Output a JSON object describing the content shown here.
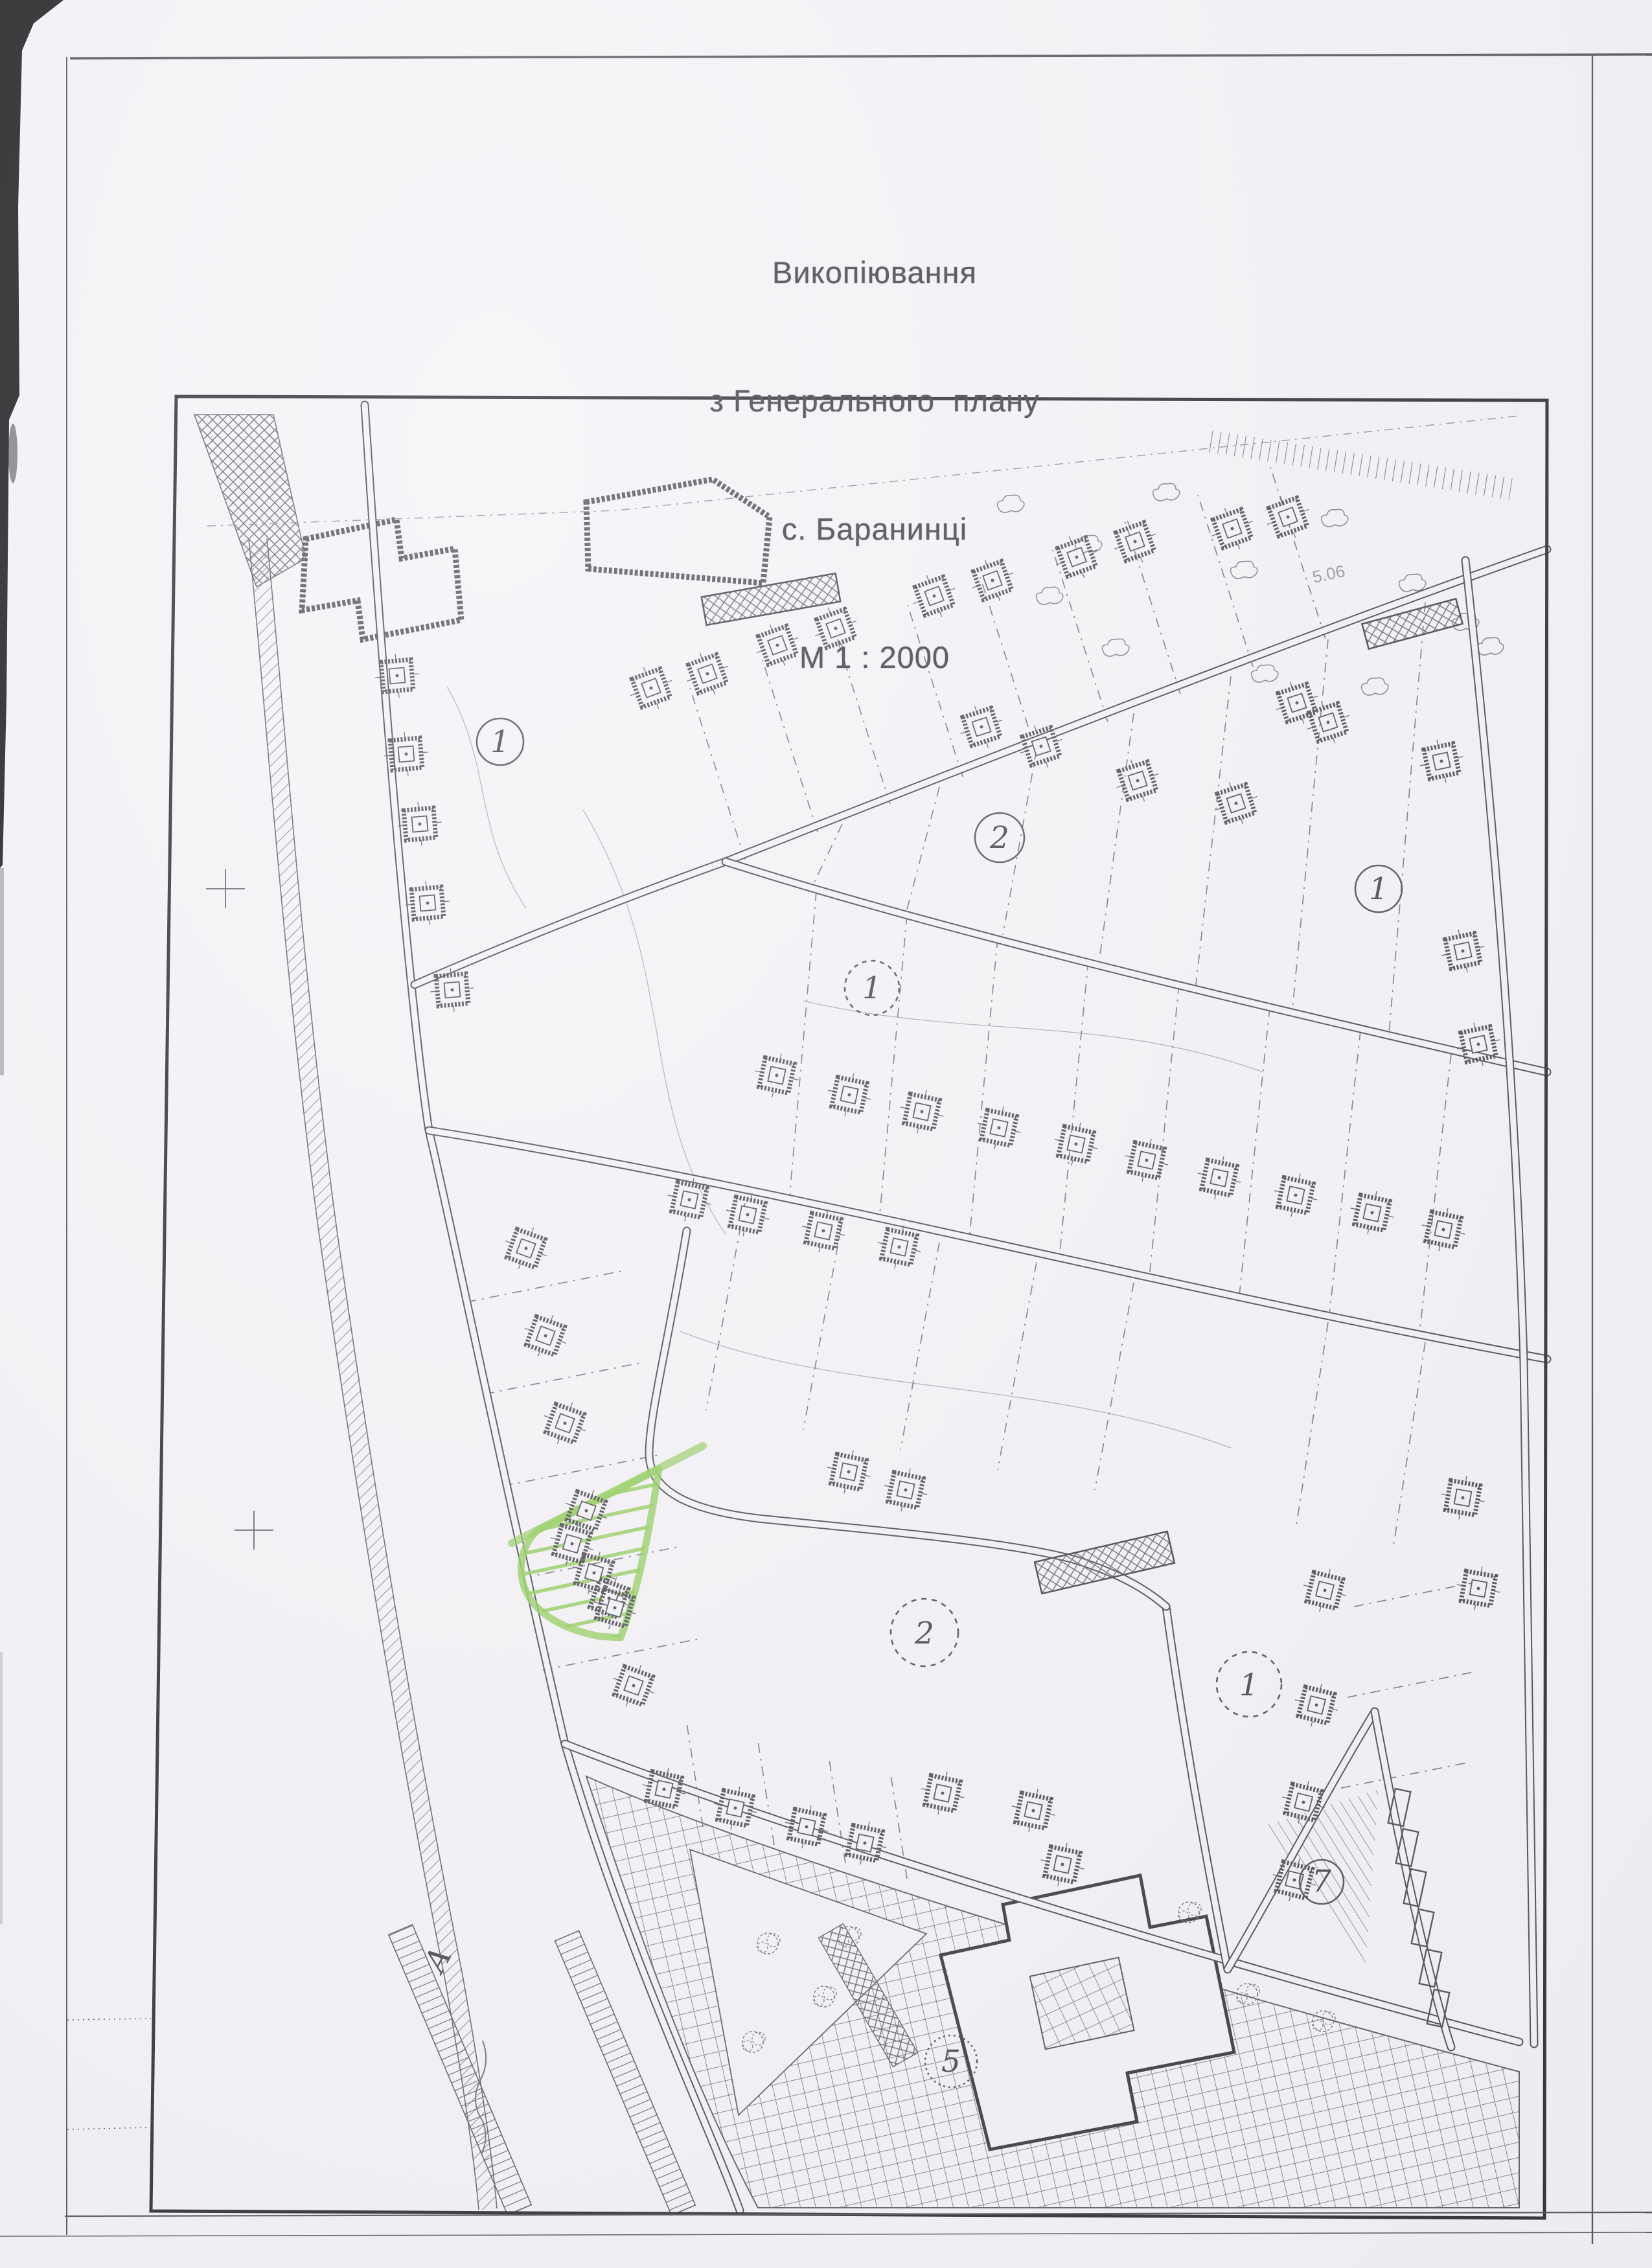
{
  "page": {
    "background": "#f4f2f6",
    "ink": "#3a3a44",
    "highlight_green": "#8ccb52"
  },
  "title": {
    "line1": "Викопіювання",
    "line2": "з Генерального  плану",
    "line3": "с. Баранинці",
    "line4": "М 1 : 2000"
  },
  "map": {
    "area_labels": {
      "farm_block": "1",
      "north_block": "2",
      "east_block": "1",
      "middle_block": "1",
      "south_block": "2",
      "southeast_block": "1",
      "school_building": "5",
      "utility_area": "7"
    },
    "road_letter": "А",
    "elevation_note": "5.06"
  }
}
